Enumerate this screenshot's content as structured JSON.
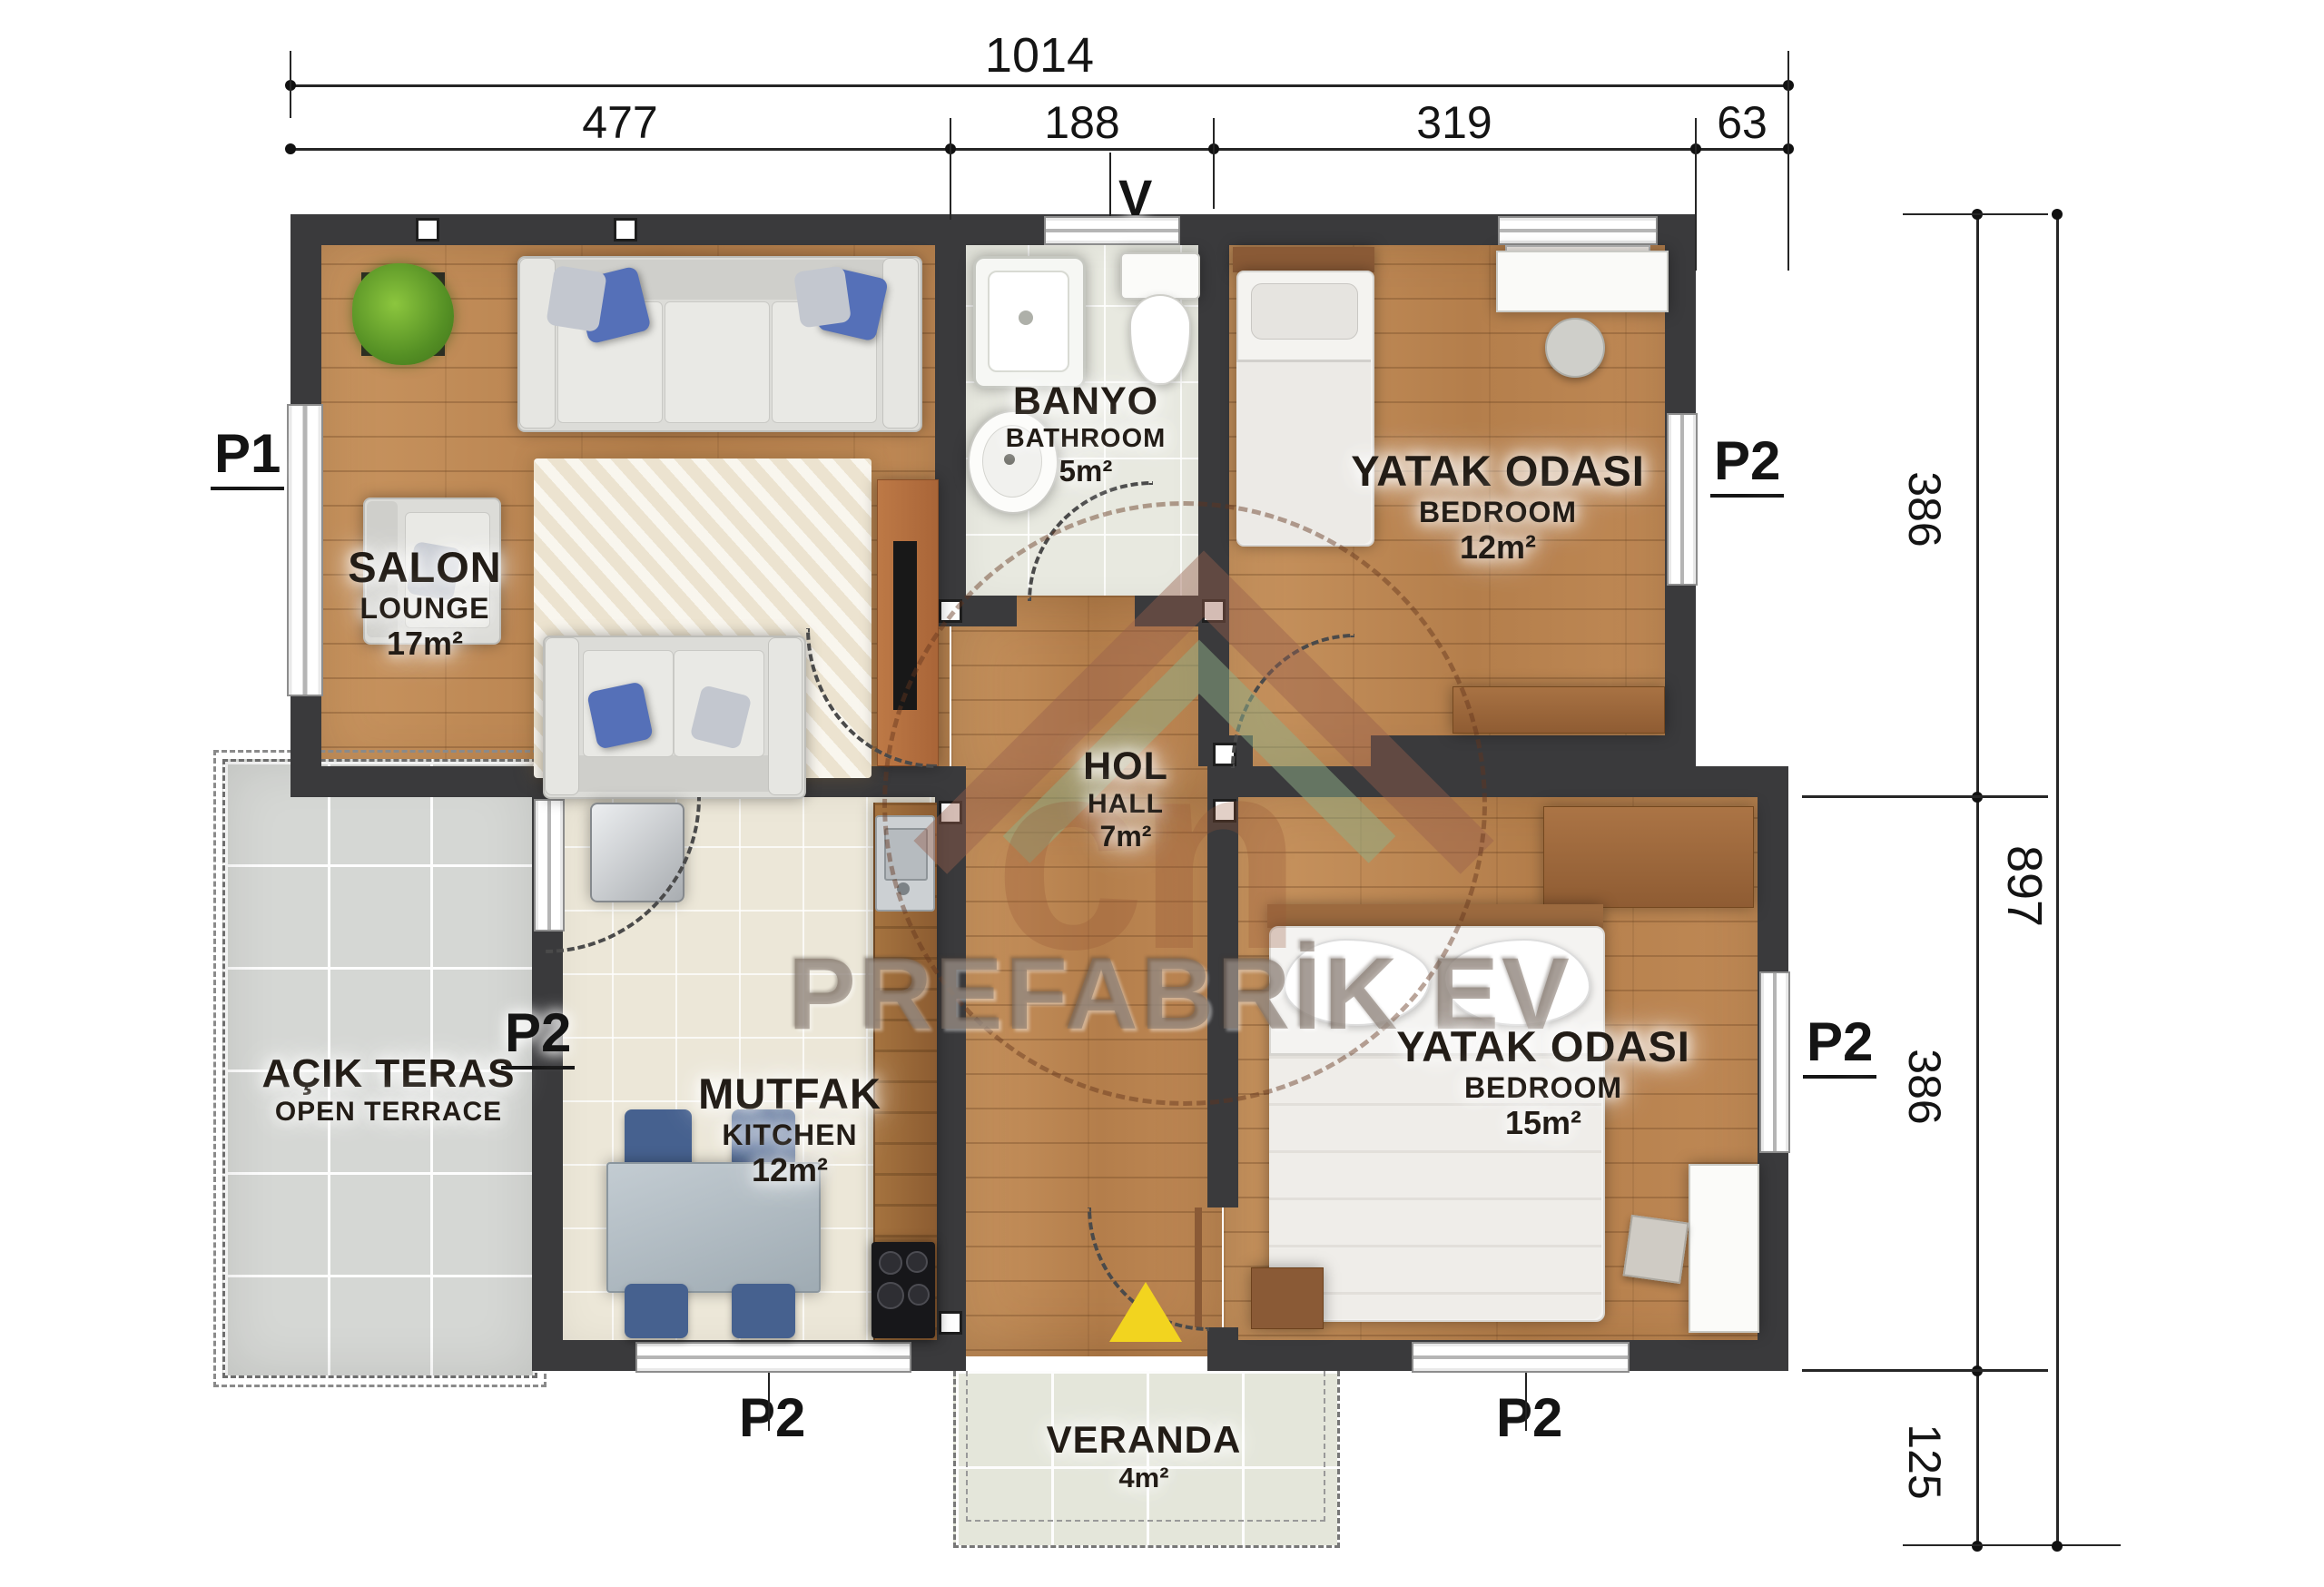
{
  "plan_title": "Prefabrik ev kat planı",
  "watermark": {
    "brand": "PREFABRİK EV",
    "logo_text": "cn"
  },
  "dimensions": {
    "top": {
      "overall": "1014",
      "segments": [
        "477",
        "188",
        "319",
        "63"
      ]
    },
    "right": {
      "overall": "897",
      "segments": [
        "386",
        "386",
        "125"
      ]
    }
  },
  "markers": {
    "p1": "P1",
    "p2": "P2",
    "v": "V"
  },
  "rooms": {
    "salon": {
      "tr": "SALON",
      "en": "LOUNGE",
      "area": "17m²"
    },
    "bathroom": {
      "tr": "BANYO",
      "en": "BATHROOM",
      "area": "5m²"
    },
    "bedroom1": {
      "tr": "YATAK ODASI",
      "en": "BEDROOM",
      "area": "12m²"
    },
    "hall": {
      "tr": "HOL",
      "en": "HALL",
      "area": "7m²"
    },
    "kitchen": {
      "tr": "MUTFAK",
      "en": "KITCHEN",
      "area": "12m²"
    },
    "bedroom2": {
      "tr": "YATAK ODASI",
      "en": "BEDROOM",
      "area": "15m²"
    },
    "veranda": {
      "tr": "VERANDA",
      "area": "4m²"
    },
    "terrace": {
      "tr": "AÇIK TERAS",
      "en": "OPEN TERRACE"
    }
  },
  "colors": {
    "wall": "#3a3a3c",
    "wood_floor": "#c28c59",
    "bath_tile": "#e8e9e0",
    "kitchen_tile": "#ece7d8",
    "terrace_tile": "#d5d7d4",
    "entry_arrow": "#f2d41f",
    "dimension_ink": "#141414"
  }
}
